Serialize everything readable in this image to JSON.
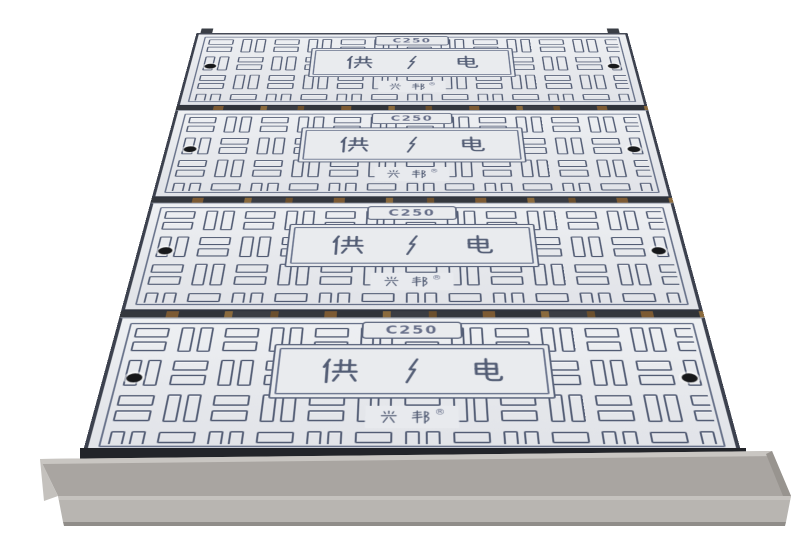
{
  "scene": {
    "type": "product-photo",
    "subject": "stack of four composite trench covers on a steel channel base",
    "background_color": "#ffffff"
  },
  "panel_common": {
    "load_class_label": "C250",
    "plaque_left_char": "供",
    "plaque_right_char": "电",
    "plaque_center_symbol": "lightning-bolt",
    "plaque_text": "供电",
    "brand_name": "兴邦",
    "registered_mark": "®",
    "bolt_holes_per_panel": 2
  },
  "panels": [
    {
      "index": 1,
      "load_class": "C250",
      "plaque_text": "供电",
      "brand": "兴邦®"
    },
    {
      "index": 2,
      "load_class": "C250",
      "plaque_text": "供电",
      "brand": "兴邦®"
    },
    {
      "index": 3,
      "load_class": "C250",
      "plaque_text": "供电",
      "brand": "兴邦®"
    },
    {
      "index": 4,
      "load_class": "C250",
      "plaque_text": "供电",
      "brand": "兴邦®"
    }
  ],
  "colors": {
    "panel_surface": "#e8eaee",
    "groove": "#525c74",
    "panel_edge": "#3c414e",
    "seam_dark": "#34373d",
    "seam_rust": "#8a6a3d",
    "bolt_hole": "#17181a",
    "frame_ledge": "#a9a5a1",
    "frame_face": "#b8b5b1",
    "frame_bottom_edge": "#908d89",
    "shadow": "#222429",
    "background": "#ffffff"
  }
}
